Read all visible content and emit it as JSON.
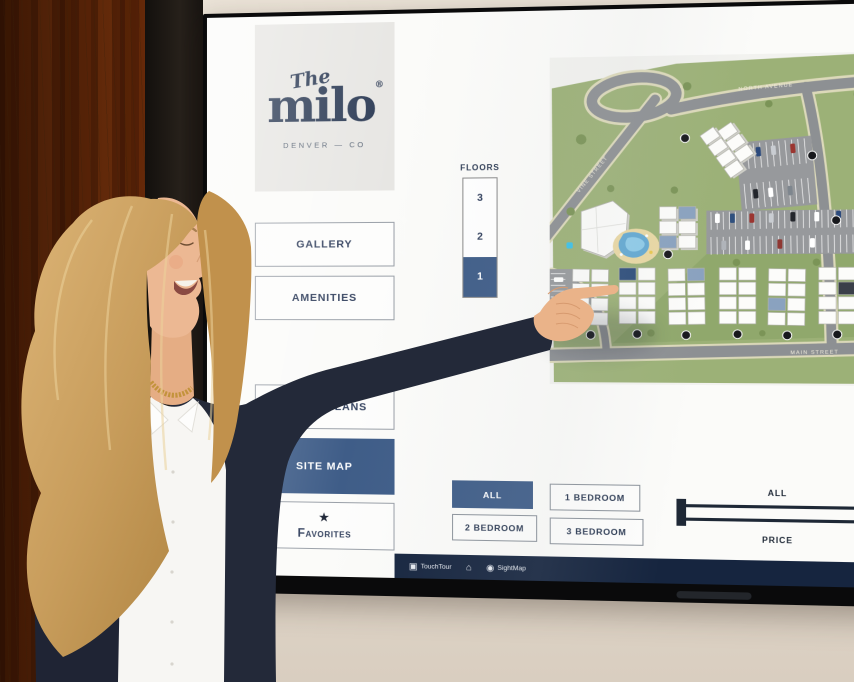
{
  "colors": {
    "accent_navy": "#3f5d88",
    "logo_navy": "#2b3a54",
    "taskbar_navy": "#16253f",
    "map_green": "#9cb177",
    "highlight_unit_blue": "#8aa2bf",
    "selected_unit_navy": "#2e4e7b"
  },
  "icons": {
    "star": "★",
    "home": "⌂",
    "touchtour": "▣",
    "sightmap": "◉"
  },
  "logo": {
    "script": "The",
    "name": "milo",
    "reg": "®",
    "location": "DENVER — CO"
  },
  "nav": {
    "items": [
      {
        "label": "GALLERY",
        "active": false
      },
      {
        "label": "AMENITIES",
        "active": false
      },
      {
        "label": "FLOOR PLANS",
        "active": false
      },
      {
        "label": "SITE MAP",
        "active": true
      },
      {
        "label": "Favorites",
        "active": false
      }
    ]
  },
  "floors": {
    "title": "FLOORS",
    "levels": [
      {
        "label": "3",
        "selected": false
      },
      {
        "label": "2",
        "selected": false
      },
      {
        "label": "1",
        "selected": true
      }
    ]
  },
  "site_map": {
    "streets": {
      "north": "NORTH AVENUE",
      "west": "VINE STREET",
      "south": "MAIN STREET"
    }
  },
  "filters": {
    "items": [
      {
        "label": "ALL",
        "active": true
      },
      {
        "label": "1 BEDROOM",
        "active": false
      },
      {
        "label": "2 BEDROOM",
        "active": false
      },
      {
        "label": "3 BEDROOM",
        "active": false
      }
    ]
  },
  "price": {
    "value": "ALL",
    "label": "PRICE"
  },
  "taskbar": {
    "app": "TouchTour",
    "map_app": "SightMap"
  }
}
